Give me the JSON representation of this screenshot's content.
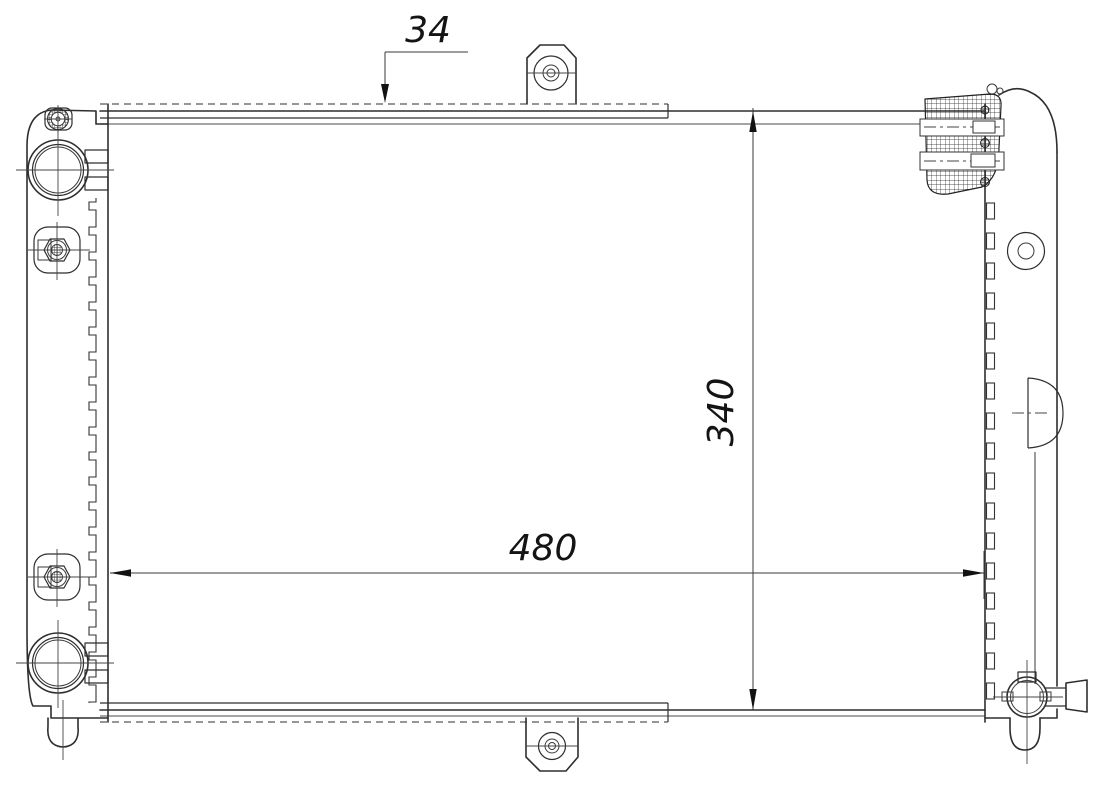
{
  "dimensions": {
    "depth_top": {
      "value": "34"
    },
    "height_right": {
      "value": "340"
    },
    "width_bottom": {
      "value": "480"
    }
  },
  "colors": {
    "background": "#ffffff",
    "primary_line": "#2e2e2e",
    "secondary_line": "#6f6f6f",
    "dimension_text": "#141414"
  }
}
